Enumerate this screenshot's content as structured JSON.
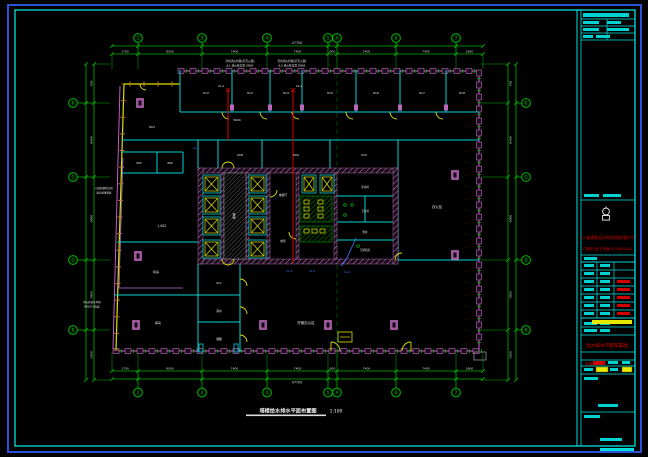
{
  "sheet": {
    "outer_border_color": "#2c52d9",
    "frame_color": "#00e0e0"
  },
  "plan": {
    "title": "塔楼给水排水平面布置图",
    "scale": "1:100",
    "grid": {
      "top": {
        "overall": "47700",
        "bubbles": [
          "1",
          "3",
          "4",
          "5",
          "A",
          "6",
          "7"
        ],
        "segments": [
          "1700",
          "8000",
          "7400",
          "7400",
          "900",
          "7400",
          "7400",
          "2600"
        ]
      },
      "bottom": {
        "overall": "47700",
        "bubbles": [
          "1",
          "3",
          "4",
          "5",
          "A",
          "6",
          "7"
        ],
        "segments": [
          "1700",
          "8000",
          "7400",
          "7400",
          "900",
          "7400",
          "7400",
          "2600"
        ]
      },
      "left": {
        "bubbles": [
          "K",
          "G",
          "D",
          "B"
        ],
        "segments": [
          "700",
          "8400",
          "9000",
          "7800",
          "5000"
        ]
      },
      "right": {
        "bubbles": [
          "K",
          "G",
          "D",
          "B"
        ],
        "segments": [
          "700",
          "8400",
          "9000",
          "7800",
          "5000"
        ]
      }
    },
    "rooms": {
      "t1": "612",
      "t2": "613",
      "t3": "614",
      "t4": "615",
      "t5": "616",
      "t6": "617",
      "t7": "618",
      "m1": "608",
      "m2": "609",
      "m3": "610",
      "l0": "604",
      "l1": "605",
      "l2": "606",
      "l3": "J-402",
      "l4": "机房",
      "l5": "库房",
      "s1": "611",
      "s2": "茶水",
      "s3": "储藏",
      "big": "开敞办公区",
      "right": "办公区",
      "c1": "电梯厅",
      "c2": "前室",
      "c3": "楼梯",
      "c4": "茶水间",
      "c5": "卫生间",
      "c6": "管井",
      "c7": "空调机房"
    },
    "risers": {
      "xl1": "XL-1",
      "xl2": "XL-2",
      "xl3": "XL-3",
      "xl4": "XL-4",
      "xl5": "XL-5",
      "xl6": "XL-6"
    },
    "annotations": {
      "top1a": "室内消火栓箱(带灭火器)",
      "top1b": "JL1-消火栓立管 DN65",
      "top2a": "室内消火栓箱(带灭火器)",
      "top2b": "JL2-消火栓立管 DN65",
      "left1": "自动喷淋给水管",
      "left2": "接自喷淋管井",
      "bl1": "消火栓给水环管",
      "bl2": "DN100 (暗装)",
      "corridor_dim": "3000"
    }
  },
  "titleblock": {
    "company": "××省建筑设计研究院有限公司",
    "certificate": "工程设计证书 甲级 A135002345",
    "drawing_title": "给水排水平面布置图",
    "drawing_no": "水施-18"
  }
}
